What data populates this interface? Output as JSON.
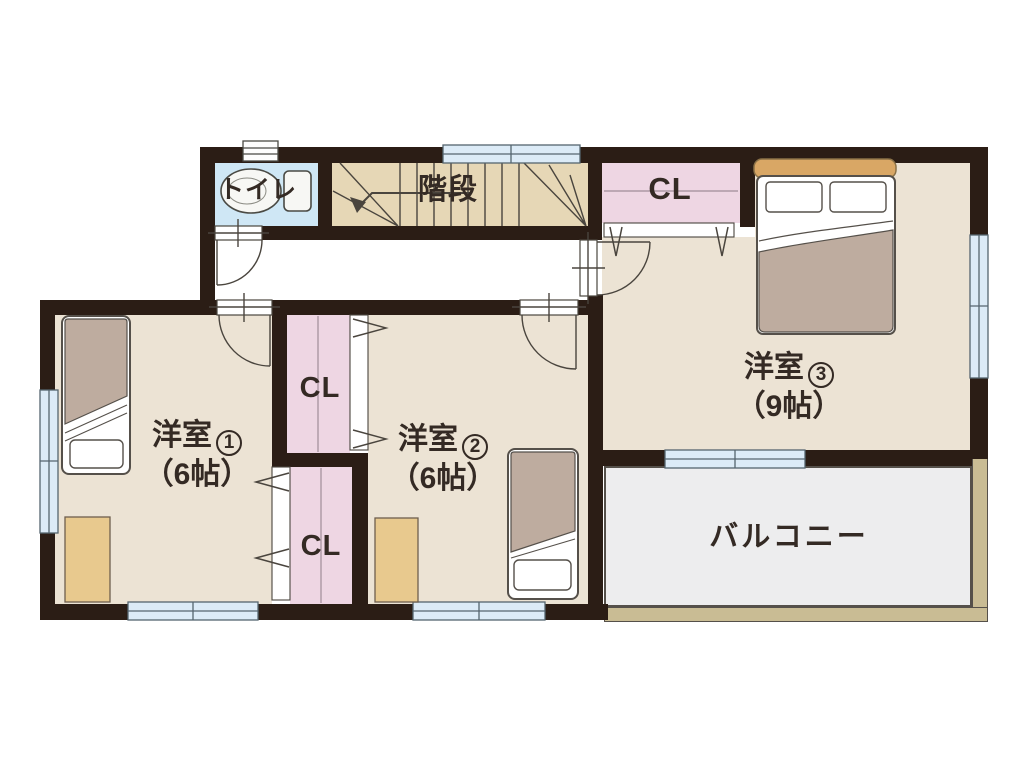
{
  "floorplan": {
    "toilet": {
      "label": "トイレ"
    },
    "stairs": {
      "label": "階段"
    },
    "hall_closet": {
      "label": "CL"
    },
    "room2_closet": {
      "label": "CL"
    },
    "room1_closet": {
      "label": "CL"
    },
    "room1": {
      "name": "洋室",
      "number": "1",
      "size": "（6帖）"
    },
    "room2": {
      "name": "洋室",
      "number": "2",
      "size": "（6帖）"
    },
    "room3": {
      "name": "洋室",
      "number": "3",
      "size": "（9帖）"
    },
    "balcony": {
      "label": "バルコニー"
    },
    "colors": {
      "wall": "#2b1d15",
      "room_floor": "#ece3d4",
      "stairs_floor": "#e6d7b6",
      "closet": "#eed6e3",
      "toilet_floor": "#cfe7f5",
      "balcony_floor": "#ededee",
      "balcony_edge": "#c9bc94",
      "window": "#dcebf7",
      "desk": "#e8c98e",
      "bedding": "#beac9f",
      "headboard": "#d9a765"
    }
  }
}
